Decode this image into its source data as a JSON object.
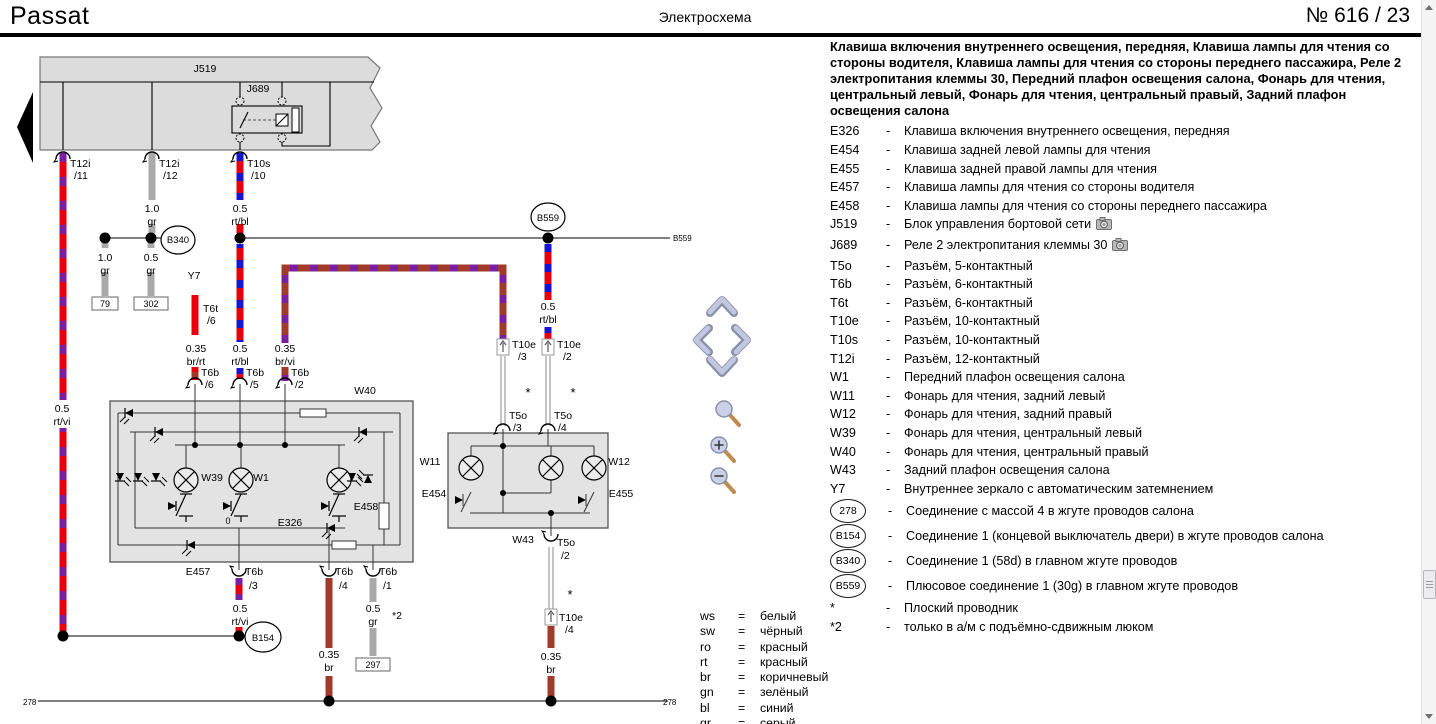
{
  "header": {
    "brand": "Passat",
    "title": "Электросхема",
    "page_label": "№  616 / 23"
  },
  "panel": {
    "dash": "-",
    "intro": "Клавиша включения внутреннего освещения, передняя, Клавиша лампы для чтения со стороны водителя, Клавиша лампы для чтения со стороны переднего пассажира, Реле 2 электропитания клеммы 30, Передний плафон освещения салона, Фонарь для чтения, центральный левый, Фонарь для чтения, центральный правый, Задний плафон освещения салона",
    "items": [
      {
        "code": "E326",
        "desc": "Клавиша включения внутреннего освещения, передняя"
      },
      {
        "code": "E454",
        "desc": "Клавиша задней левой лампы для чтения"
      },
      {
        "code": "E455",
        "desc": "Клавиша задней правой лампы для чтения"
      },
      {
        "code": "E457",
        "desc": "Клавиша лампы для чтения со стороны водителя"
      },
      {
        "code": "E458",
        "desc": "Клавиша лампы для чтения со стороны переднего пассажира"
      },
      {
        "code": "J519",
        "desc": "Блок управления бортовой сети",
        "camera": true
      },
      {
        "code": "J689",
        "desc": "Реле 2 электропитания клеммы 30",
        "camera": true
      },
      {
        "code": "T5o",
        "desc": "Разъём, 5-контактный"
      },
      {
        "code": "T6b",
        "desc": "Разъём, 6-контактный"
      },
      {
        "code": "T6t",
        "desc": "Разъём, 6-контактный"
      },
      {
        "code": "T10e",
        "desc": "Разъём, 10-контактный"
      },
      {
        "code": "T10s",
        "desc": "Разъём, 10-контактный"
      },
      {
        "code": "T12i",
        "desc": "Разъём, 12-контактный"
      },
      {
        "code": "W1",
        "desc": "Передний плафон освещения салона"
      },
      {
        "code": "W11",
        "desc": "Фонарь для чтения, задний левый"
      },
      {
        "code": "W12",
        "desc": "Фонарь для чтения, задний правый"
      },
      {
        "code": "W39",
        "desc": "Фонарь для чтения, центральный левый"
      },
      {
        "code": "W40",
        "desc": "Фонарь для чтения, центральный правый"
      },
      {
        "code": "W43",
        "desc": "Задний плафон освещения салона"
      },
      {
        "code": "Y7",
        "desc": "Внутреннее зеркало с автоматическим затемнением"
      },
      {
        "code": "278",
        "circle": true,
        "desc": "Соединение с массой 4 в жгуте проводов салона"
      },
      {
        "code": "B154",
        "circle": true,
        "desc": "Соединение 1 (концевой выключатель двери) в жгуте проводов салона"
      },
      {
        "code": "B340",
        "circle": true,
        "desc": "Соединение 1 (58d) в главном жгуте проводов"
      },
      {
        "code": "B559",
        "circle": true,
        "desc": "Плюсовое соединение 1 (30g) в главном жгуте проводов"
      },
      {
        "code": "*",
        "desc": "Плоский проводник"
      },
      {
        "code": "*2",
        "desc": "только в а/м с подъёмно-сдвижным люком"
      }
    ]
  },
  "color_key": {
    "eq": "=",
    "items": [
      {
        "abbr": "ws",
        "name": "белый"
      },
      {
        "abbr": "sw",
        "name": "чёрный"
      },
      {
        "abbr": "ro",
        "name": "красный"
      },
      {
        "abbr": "rt",
        "name": "красный"
      },
      {
        "abbr": "br",
        "name": "коричневый"
      },
      {
        "abbr": "gn",
        "name": "зелёный"
      },
      {
        "abbr": "bl",
        "name": "синий"
      },
      {
        "abbr": "gr",
        "name": "серый"
      }
    ]
  },
  "colors": {
    "wire_red": "#e8000d",
    "wire_violet": "#7a1fa2",
    "wire_blue": "#1616d0",
    "wire_brown": "#a03a2a",
    "wire_gray": "#a9a9a9",
    "box_fill": "#e0e0e0"
  },
  "diagram": {
    "labels": [
      {
        "x": 205,
        "y": 72,
        "t": "J519"
      },
      {
        "x": 258,
        "y": 92,
        "t": "J689"
      },
      {
        "x": 70,
        "y": 167,
        "t": "T12i",
        "a": "s"
      },
      {
        "x": 74,
        "y": 179,
        "t": "/11",
        "a": "s"
      },
      {
        "x": 159,
        "y": 167,
        "t": "T12i",
        "a": "s"
      },
      {
        "x": 163,
        "y": 179,
        "t": "/12",
        "a": "s"
      },
      {
        "x": 247,
        "y": 167,
        "t": "T10s",
        "a": "s"
      },
      {
        "x": 251,
        "y": 179,
        "t": "/10",
        "a": "s"
      },
      {
        "x": 152,
        "y": 212,
        "t": "1.0"
      },
      {
        "x": 152,
        "y": 225,
        "t": "gr"
      },
      {
        "x": 240,
        "y": 212,
        "t": "0.5"
      },
      {
        "x": 240,
        "y": 225,
        "t": "rt/bl"
      },
      {
        "x": 105,
        "y": 261,
        "t": "1.0"
      },
      {
        "x": 105,
        "y": 274,
        "t": "gr"
      },
      {
        "x": 151,
        "y": 261,
        "t": "0.5"
      },
      {
        "x": 151,
        "y": 274,
        "t": "gr"
      },
      {
        "x": 194,
        "y": 279,
        "t": "Y7"
      },
      {
        "x": 203,
        "y": 312,
        "t": "T6t",
        "a": "s"
      },
      {
        "x": 207,
        "y": 324,
        "t": "/6",
        "a": "s"
      },
      {
        "x": 196,
        "y": 352,
        "t": "0.35"
      },
      {
        "x": 196,
        "y": 365,
        "t": "br/rt"
      },
      {
        "x": 240,
        "y": 352,
        "t": "0.5"
      },
      {
        "x": 240,
        "y": 365,
        "t": "rt/bl"
      },
      {
        "x": 285,
        "y": 352,
        "t": "0.35"
      },
      {
        "x": 285,
        "y": 365,
        "t": "br/vi"
      },
      {
        "x": 548,
        "y": 310,
        "t": "0.5"
      },
      {
        "x": 548,
        "y": 323,
        "t": "rt/bl"
      },
      {
        "x": 62,
        "y": 412,
        "t": "0.5"
      },
      {
        "x": 62,
        "y": 425,
        "t": "rt/vi"
      },
      {
        "x": 673,
        "y": 241,
        "t": "B559",
        "s": 8,
        "a": "s"
      },
      {
        "x": 201,
        "y": 376,
        "t": "T6b",
        "a": "s"
      },
      {
        "x": 205,
        "y": 388,
        "t": "/6",
        "a": "s"
      },
      {
        "x": 246,
        "y": 376,
        "t": "T6b",
        "a": "s"
      },
      {
        "x": 250,
        "y": 388,
        "t": "/5",
        "a": "s"
      },
      {
        "x": 291,
        "y": 376,
        "t": "T6b",
        "a": "s"
      },
      {
        "x": 295,
        "y": 388,
        "t": "/2",
        "a": "s"
      },
      {
        "x": 365,
        "y": 394,
        "t": "W40"
      },
      {
        "x": 212,
        "y": 481,
        "t": "W39"
      },
      {
        "x": 261,
        "y": 481,
        "t": "W1"
      },
      {
        "x": 290,
        "y": 526,
        "t": "E326"
      },
      {
        "x": 366,
        "y": 510,
        "t": "E458"
      },
      {
        "x": 198,
        "y": 575,
        "t": "E457"
      },
      {
        "x": 228,
        "y": 524,
        "t": "0",
        "s": 9
      },
      {
        "x": 245,
        "y": 575,
        "t": "T6b",
        "a": "s"
      },
      {
        "x": 249,
        "y": 589,
        "t": "/3",
        "a": "s"
      },
      {
        "x": 335,
        "y": 575,
        "t": "T6b",
        "a": "s"
      },
      {
        "x": 339,
        "y": 589,
        "t": "/4",
        "a": "s"
      },
      {
        "x": 379,
        "y": 575,
        "t": "T6b",
        "a": "s"
      },
      {
        "x": 383,
        "y": 589,
        "t": "/1",
        "a": "s"
      },
      {
        "x": 240,
        "y": 612,
        "t": "0.5"
      },
      {
        "x": 240,
        "y": 625,
        "t": "rt/vi"
      },
      {
        "x": 329,
        "y": 658,
        "t": "0.35"
      },
      {
        "x": 329,
        "y": 671,
        "t": "br"
      },
      {
        "x": 373,
        "y": 612,
        "t": "0.5"
      },
      {
        "x": 373,
        "y": 625,
        "t": "gr"
      },
      {
        "x": 397,
        "y": 619,
        "t": "*2"
      },
      {
        "x": 512,
        "y": 348,
        "t": "T10e",
        "a": "s"
      },
      {
        "x": 518,
        "y": 360,
        "t": "/3",
        "a": "s"
      },
      {
        "x": 557,
        "y": 348,
        "t": "T10e",
        "a": "s"
      },
      {
        "x": 563,
        "y": 360,
        "t": "/2",
        "a": "s"
      },
      {
        "x": 509,
        "y": 419,
        "t": "T5o",
        "a": "s"
      },
      {
        "x": 513,
        "y": 431,
        "t": "/3",
        "a": "s"
      },
      {
        "x": 554,
        "y": 419,
        "t": "T5o",
        "a": "s"
      },
      {
        "x": 558,
        "y": 431,
        "t": "/4",
        "a": "s"
      },
      {
        "x": 430,
        "y": 465,
        "t": "W11"
      },
      {
        "x": 619,
        "y": 465,
        "t": "W12"
      },
      {
        "x": 434,
        "y": 497,
        "t": "E454"
      },
      {
        "x": 621,
        "y": 497,
        "t": "E455"
      },
      {
        "x": 523,
        "y": 543,
        "t": "W43"
      },
      {
        "x": 557,
        "y": 546,
        "t": "T5o",
        "a": "s"
      },
      {
        "x": 561,
        "y": 559,
        "t": "/2",
        "a": "s"
      },
      {
        "x": 559,
        "y": 621,
        "t": "T10e",
        "a": "s"
      },
      {
        "x": 565,
        "y": 633,
        "t": "/4",
        "a": "s"
      },
      {
        "x": 551,
        "y": 660,
        "t": "0.35"
      },
      {
        "x": 551,
        "y": 673,
        "t": "br"
      },
      {
        "x": 528,
        "y": 397,
        "t": "*",
        "s": 13
      },
      {
        "x": 573,
        "y": 397,
        "t": "*",
        "s": 13
      },
      {
        "x": 570,
        "y": 599,
        "t": "*",
        "s": 13
      },
      {
        "x": 23,
        "y": 705,
        "t": "278",
        "s": 8,
        "a": "s"
      },
      {
        "x": 663,
        "y": 705,
        "t": "278",
        "s": 8,
        "a": "s"
      },
      {
        "x": 178,
        "y": 243,
        "t": "B340",
        "s": 9.5
      },
      {
        "x": 548,
        "y": 221,
        "t": "B559",
        "s": 9.5
      },
      {
        "x": 263,
        "y": 641,
        "t": "B154",
        "s": 9.5
      },
      {
        "x": 105,
        "y": 307,
        "t": "79",
        "s": 9
      },
      {
        "x": 151,
        "y": 307,
        "t": "302",
        "s": 9
      },
      {
        "x": 373,
        "y": 668,
        "t": "297",
        "s": 9,
        "c": "#7b3025"
      }
    ]
  }
}
